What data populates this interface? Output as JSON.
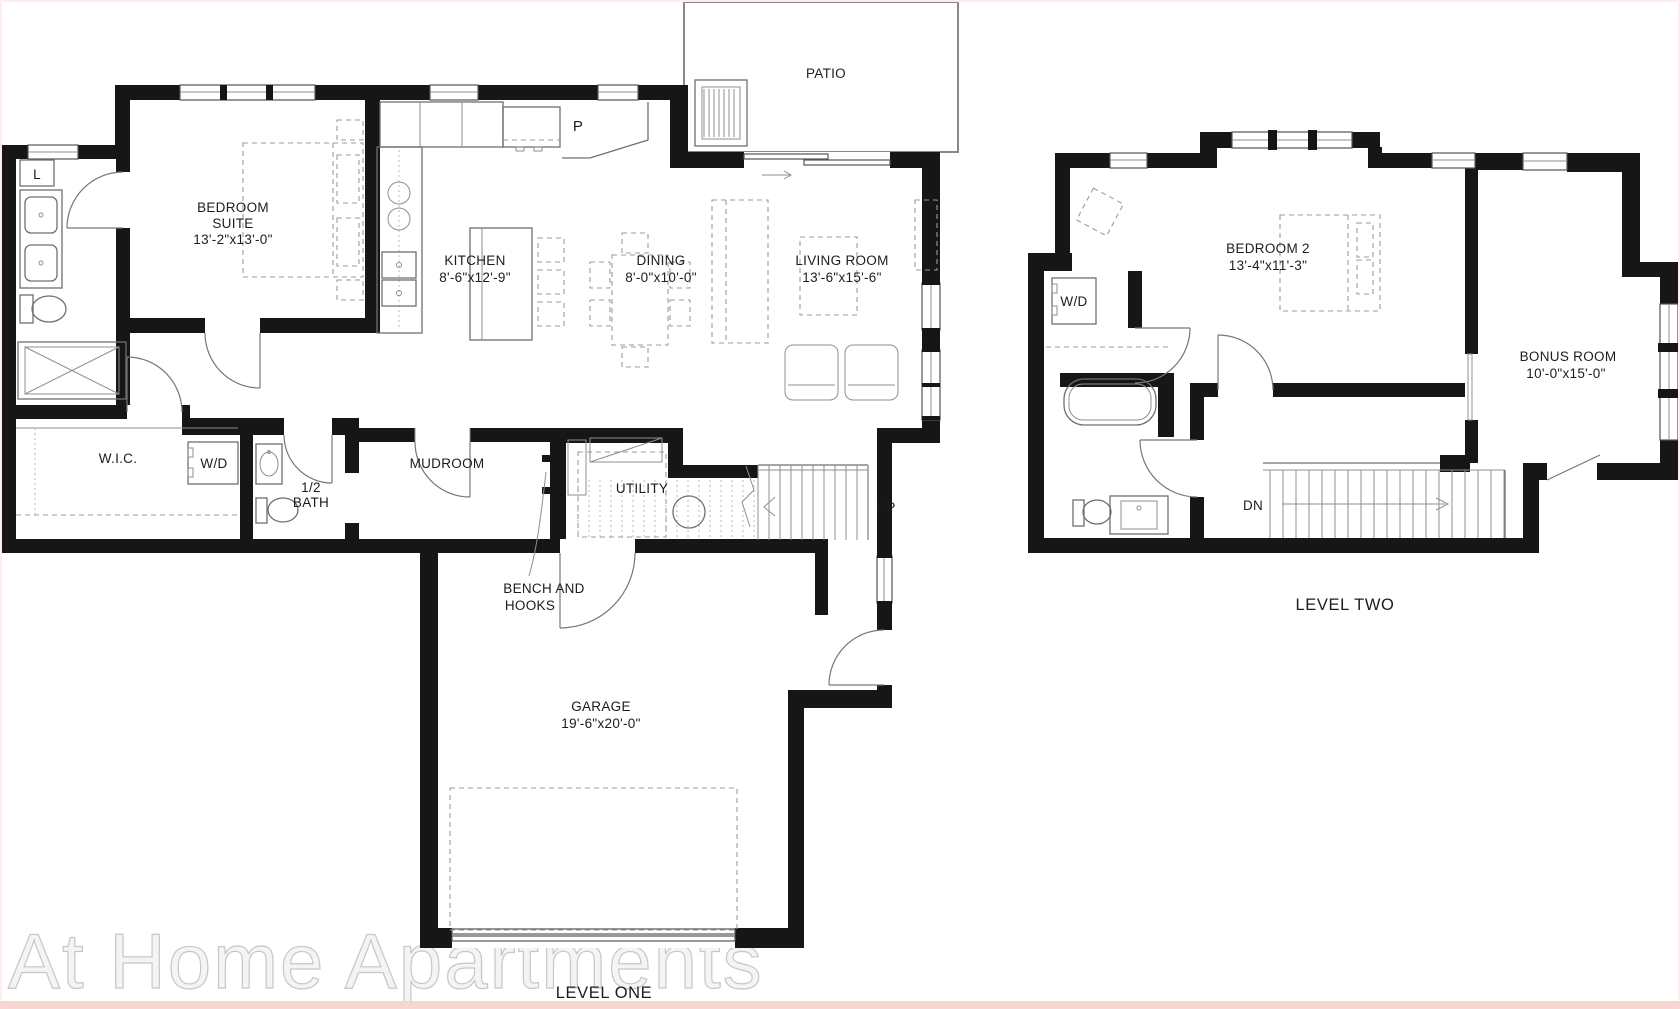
{
  "watermark": "At Home Apartments",
  "colors": {
    "wall": "#161616",
    "thin_line": "#6f6f6f",
    "dashed": "#9b9b9b",
    "border_pink": "#f8d7d3"
  },
  "level_one": {
    "title": "LEVEL ONE",
    "patio": "PATIO",
    "linen": "L",
    "pantry": "P",
    "bedroom_suite": {
      "line1": "BEDROOM",
      "line2": "SUITE",
      "dims": "13'-2\"x13'-0\""
    },
    "kitchen": {
      "name": "KITCHEN",
      "dims": "8'-6\"x12'-9\""
    },
    "dining": {
      "name": "DINING",
      "dims": "8'-0\"x10'-0\""
    },
    "living_room": {
      "name": "LIVING ROOM",
      "dims": "13'-6\"x15'-6\""
    },
    "wic": "W.I.C.",
    "washer_dryer": "W/D",
    "half_bath": {
      "line1": "1/2",
      "line2": "BATH"
    },
    "mudroom": "MUDROOM",
    "utility": "UTILITY",
    "up": "UP",
    "bench": {
      "line1": "BENCH AND",
      "line2": "HOOKS"
    },
    "garage": {
      "name": "GARAGE",
      "dims": "19'-6\"x20'-0\""
    }
  },
  "level_two": {
    "title": "LEVEL TWO",
    "bedroom2": {
      "name": "BEDROOM 2",
      "dims": "13'-4\"x11'-3\""
    },
    "bonus_room": {
      "name": "BONUS ROOM",
      "dims": "10'-0\"x15'-0\""
    },
    "washer_dryer": "W/D",
    "dn": "DN"
  }
}
